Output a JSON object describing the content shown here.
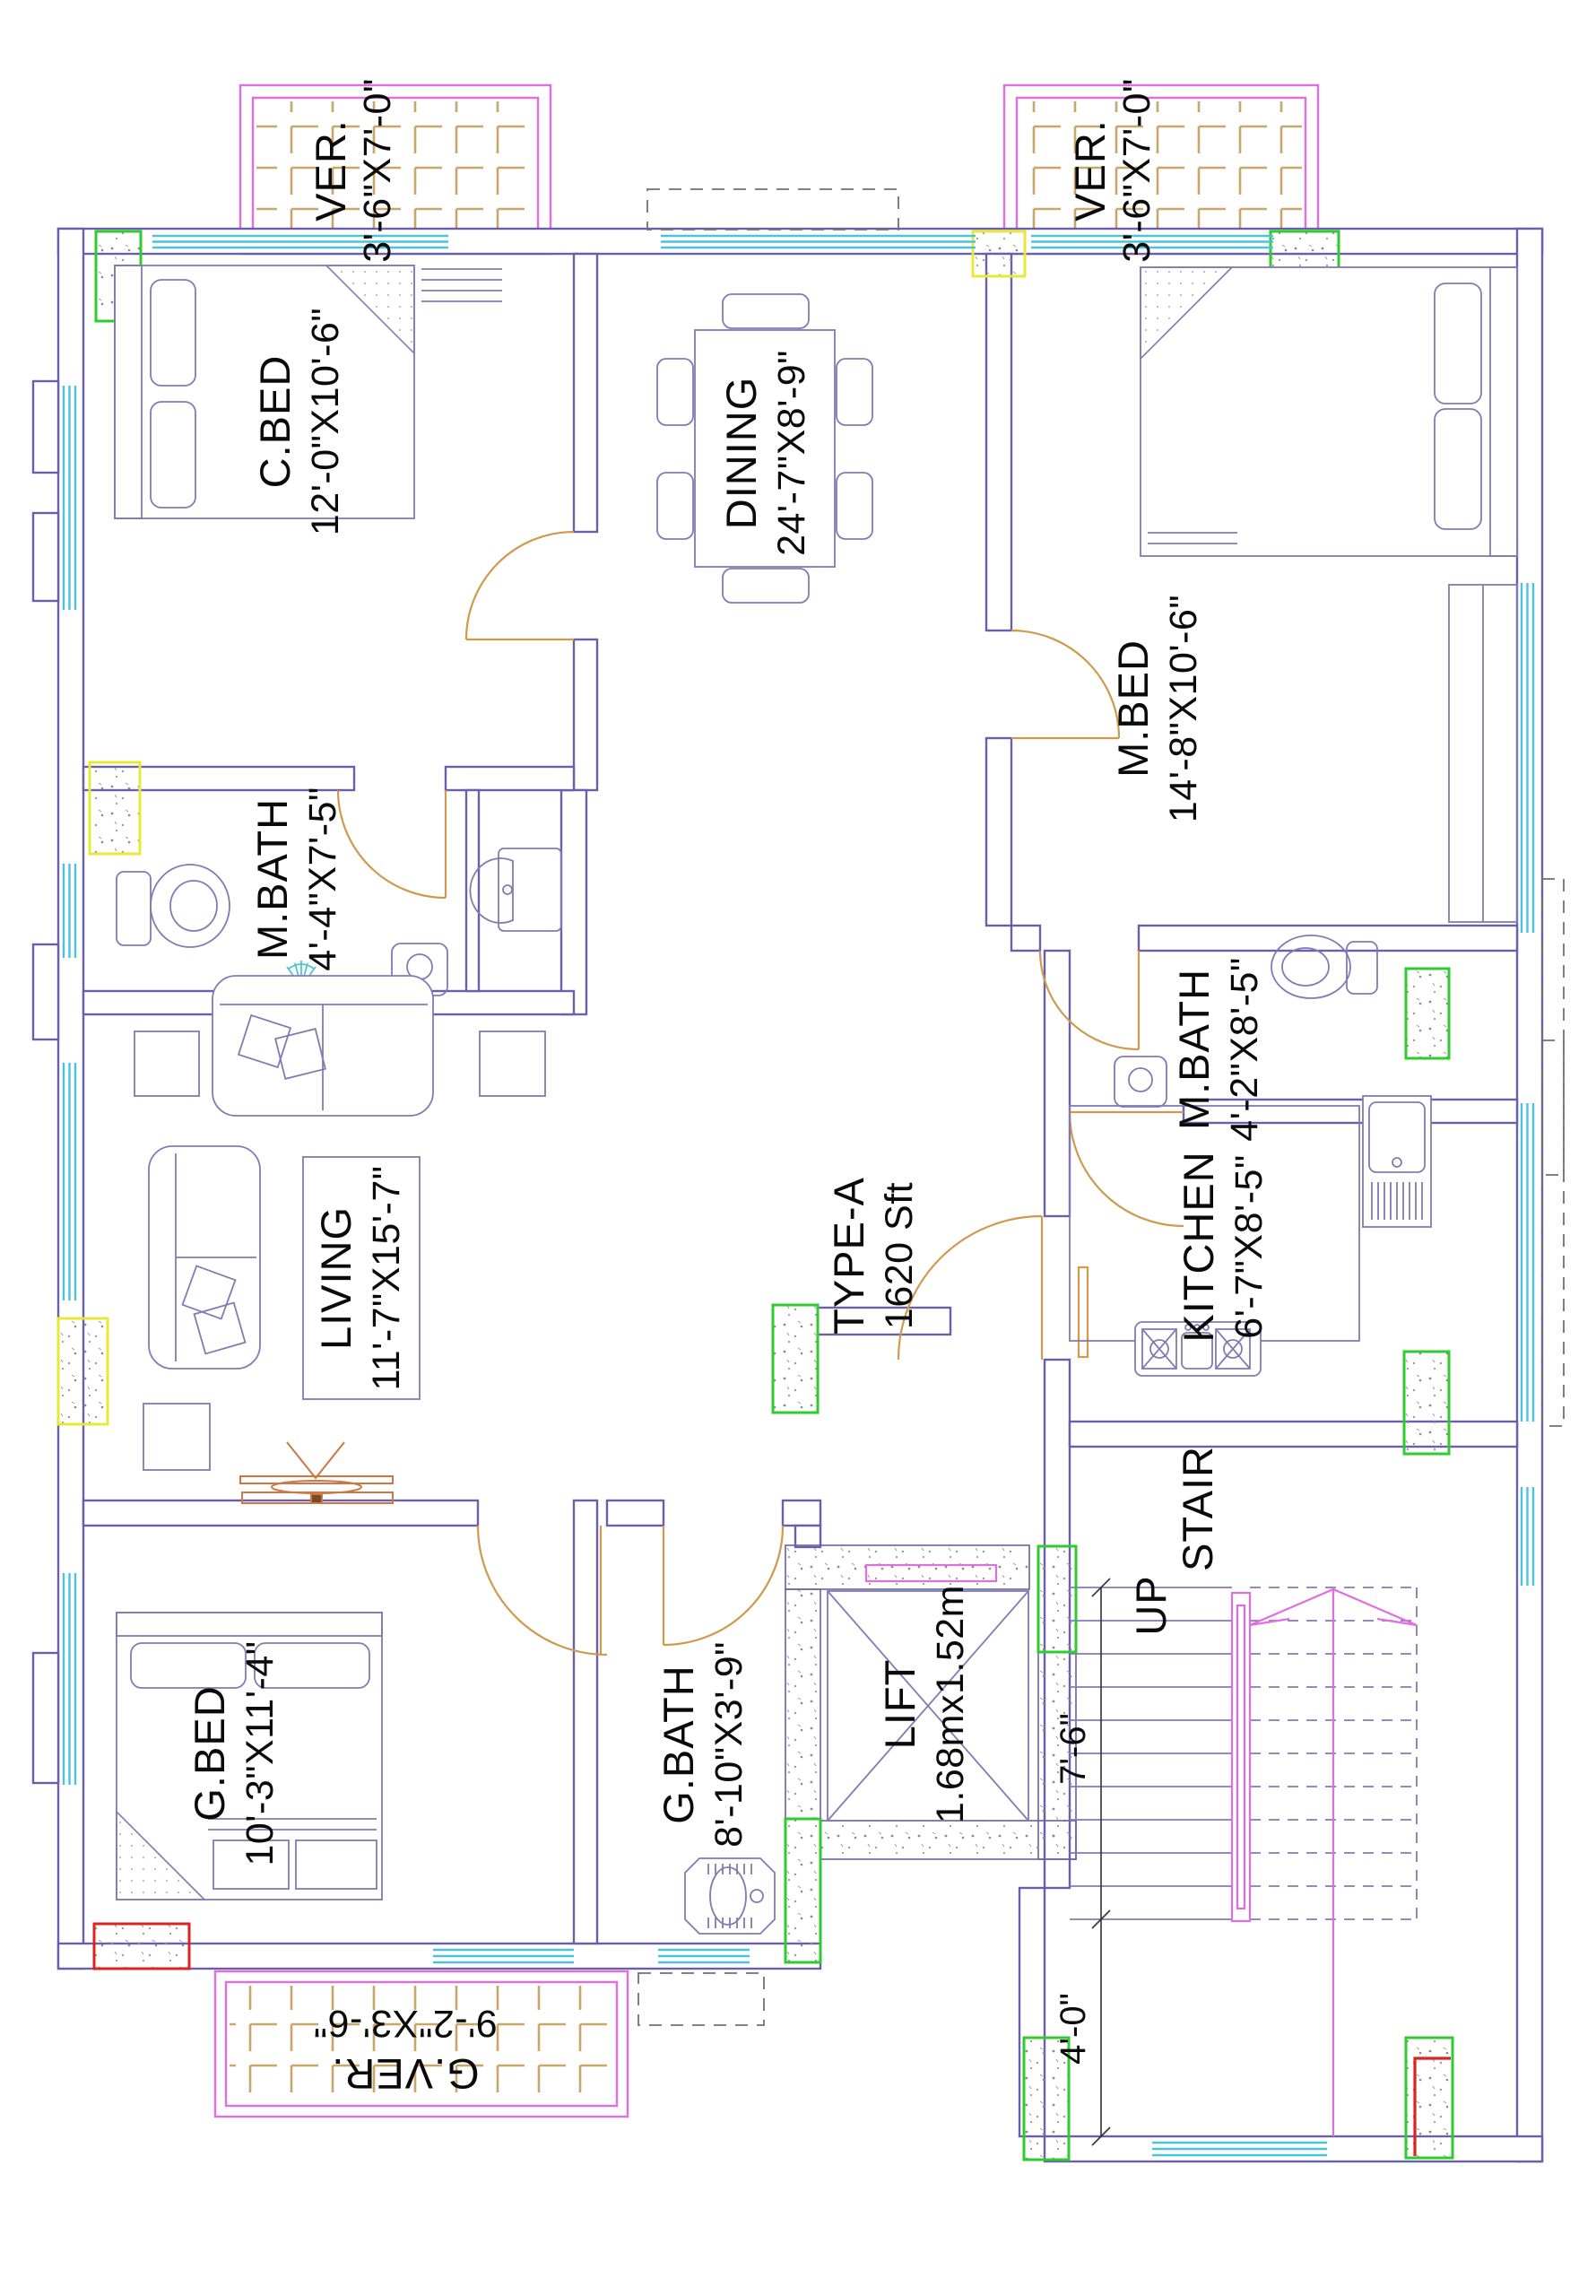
{
  "unit": {
    "type": "TYPE-A",
    "area": "1620 Sft"
  },
  "rooms": {
    "ver_left": {
      "name": "VER.",
      "size": "3'-6\"X7'-0\""
    },
    "ver_right": {
      "name": "VER.",
      "size": "3'-6\"X7'-0\""
    },
    "c_bed": {
      "name": "C.BED",
      "size": "12'-0\"X10'-6\""
    },
    "dining": {
      "name": "DINING",
      "size": "24'-7\"X8'-9\""
    },
    "m_bed": {
      "name": "M.BED",
      "size": "14'-8\"X10'-6\""
    },
    "m_bath_left": {
      "name": "M.BATH",
      "size": "4'-4\"X7'-5\""
    },
    "m_bath_right": {
      "name": "M.BATH",
      "size": "4'-2\"X8'-5\""
    },
    "living": {
      "name": "LIVING",
      "size": "11'-7\"X15'-7\""
    },
    "kitchen": {
      "name": "KITCHEN",
      "size": "6'-7\"X8'-5\""
    },
    "g_bed": {
      "name": "G.BED",
      "size": "10'-3\"X11'-4\""
    },
    "g_bath": {
      "name": "G.BATH",
      "size": "8'-10\"X3'-9\""
    },
    "g_ver": {
      "name": "G.VER.",
      "size": "9'-2\"X3'-6\""
    },
    "lift": {
      "name": "LIFT",
      "size": "1.68mx1.52m"
    },
    "stair": {
      "name": "STAIR"
    }
  },
  "stair_annotations": {
    "direction": "UP",
    "flight_width": "7'-6\"",
    "landing_depth": "4'-0\""
  },
  "colors": {
    "wall": "#6b5fa8",
    "furniture": "#8579b4",
    "window": "#4cc3dc",
    "door": "#cf9a4e",
    "veranda_border": "#e06ee0",
    "tile": "#c9a66b",
    "column_green": "#2ecc2e",
    "column_yellow": "#e8e838",
    "column_red": "#dd2222",
    "stair_rail": "#e06ee0",
    "text": "#0a0a0a"
  }
}
